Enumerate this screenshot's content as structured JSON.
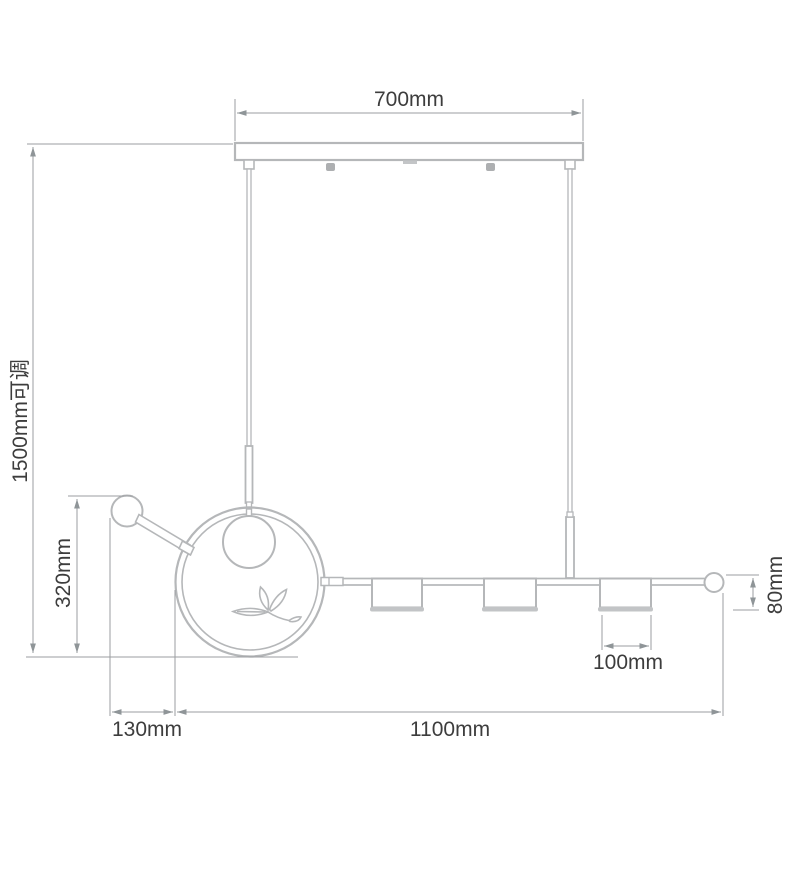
{
  "diagram": {
    "title": "pendant-lamp-dimension-diagram",
    "labels": {
      "ceiling_width": "700mm",
      "drop_height": "1500mm可调",
      "fixture_height": "320mm",
      "left_offset": "130mm",
      "bar_length": "1100mm",
      "shade_width": "100mm",
      "shade_height": "80mm"
    }
  },
  "colors": {
    "background": "#ffffff",
    "fixture_line": "#b5b7b9",
    "fixture_fill": "#ffffff",
    "hardware_fill": "#adafb1",
    "rim_fill": "#c2c4c6",
    "dimension_line": "#9b9ea1",
    "arrow_fill": "#8f9598",
    "label_text": "#3d3d3d"
  }
}
